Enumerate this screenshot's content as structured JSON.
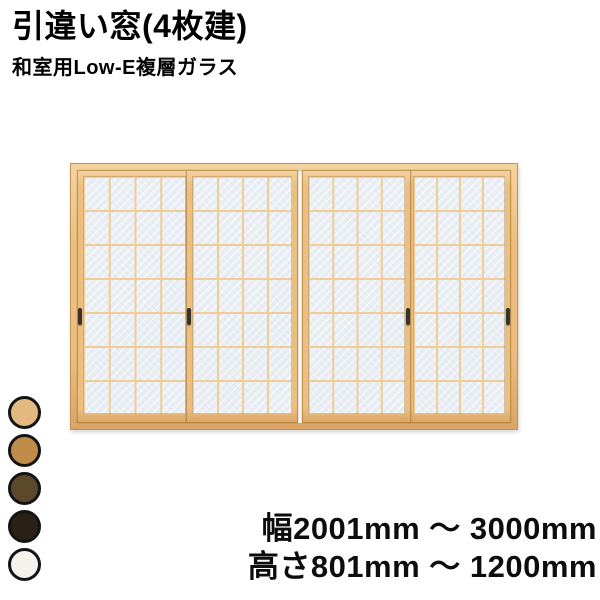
{
  "header": {
    "title": "引違い窓(4枚建)",
    "subtitle": "和室用Low-E複層ガラス"
  },
  "window": {
    "description": "4-panel sliding shoji-style window illustration",
    "panel_count": 4,
    "grid_columns_per_panel": 4,
    "grid_rows_per_panel": 7,
    "handle_count": 4,
    "colors": {
      "wood": "#ecbf80",
      "wood_edge": "#c2905a",
      "muntin": "#f0cc96",
      "glass": "#e9eef3",
      "handle": "#37322c",
      "track_bg": "#faf6ef"
    }
  },
  "swatches": [
    {
      "name": "light-wood",
      "color": "#e2b97e"
    },
    {
      "name": "medium-wood",
      "color": "#c08c4a"
    },
    {
      "name": "dark-olive-wood",
      "color": "#5c492a"
    },
    {
      "name": "dark-brown",
      "color": "#2b2015"
    },
    {
      "name": "off-white",
      "color": "#f5f2eb"
    }
  ],
  "specs": {
    "width_range": "幅2001mm ～ 3000mm",
    "height_range": "高さ801mm ～ 1200mm"
  }
}
